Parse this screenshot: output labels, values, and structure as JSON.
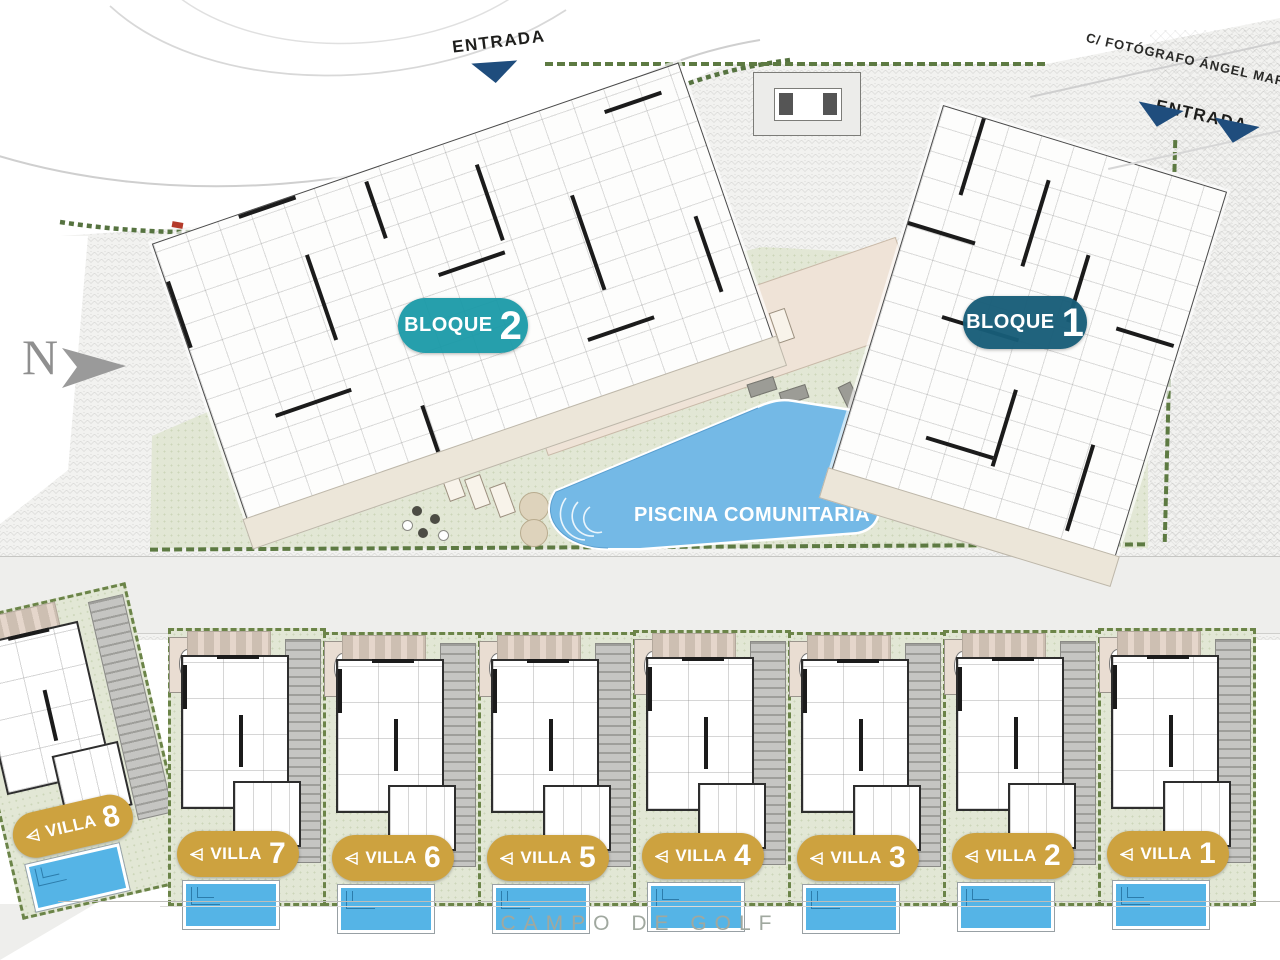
{
  "plan": {
    "street_label": "C/ FOTÓGRAFO ÁNGEL MARTÍN",
    "entrance_top": "ENTRADA",
    "entrance_right": "ENTRADA",
    "north_label": "N",
    "pool_label": "PISCINA COMUNITARIA",
    "golf_label": "CAMPO DE GOLF",
    "blocks": [
      {
        "name": "BLOQUE",
        "number": "1",
        "color": "#175d78"
      },
      {
        "name": "BLOQUE",
        "number": "2",
        "color": "#1a9aa8"
      }
    ],
    "villas": [
      {
        "name": "VILLA",
        "number": "8"
      },
      {
        "name": "VILLA",
        "number": "7"
      },
      {
        "name": "VILLA",
        "number": "6"
      },
      {
        "name": "VILLA",
        "number": "5"
      },
      {
        "name": "VILLA",
        "number": "4"
      },
      {
        "name": "VILLA",
        "number": "3"
      },
      {
        "name": "VILLA",
        "number": "2"
      },
      {
        "name": "VILLA",
        "number": "1"
      }
    ],
    "colors": {
      "bloque1": "#175d78",
      "bloque2": "#1a9aa8",
      "villa_gold": "#cda23f",
      "entrance_navy": "#1f4d7d",
      "pool_blue": "#74b9e6",
      "villa_pool_blue": "#55b4e6",
      "lawn_green": "#e2e7d5",
      "hedge_green": "#5d7a42"
    }
  }
}
